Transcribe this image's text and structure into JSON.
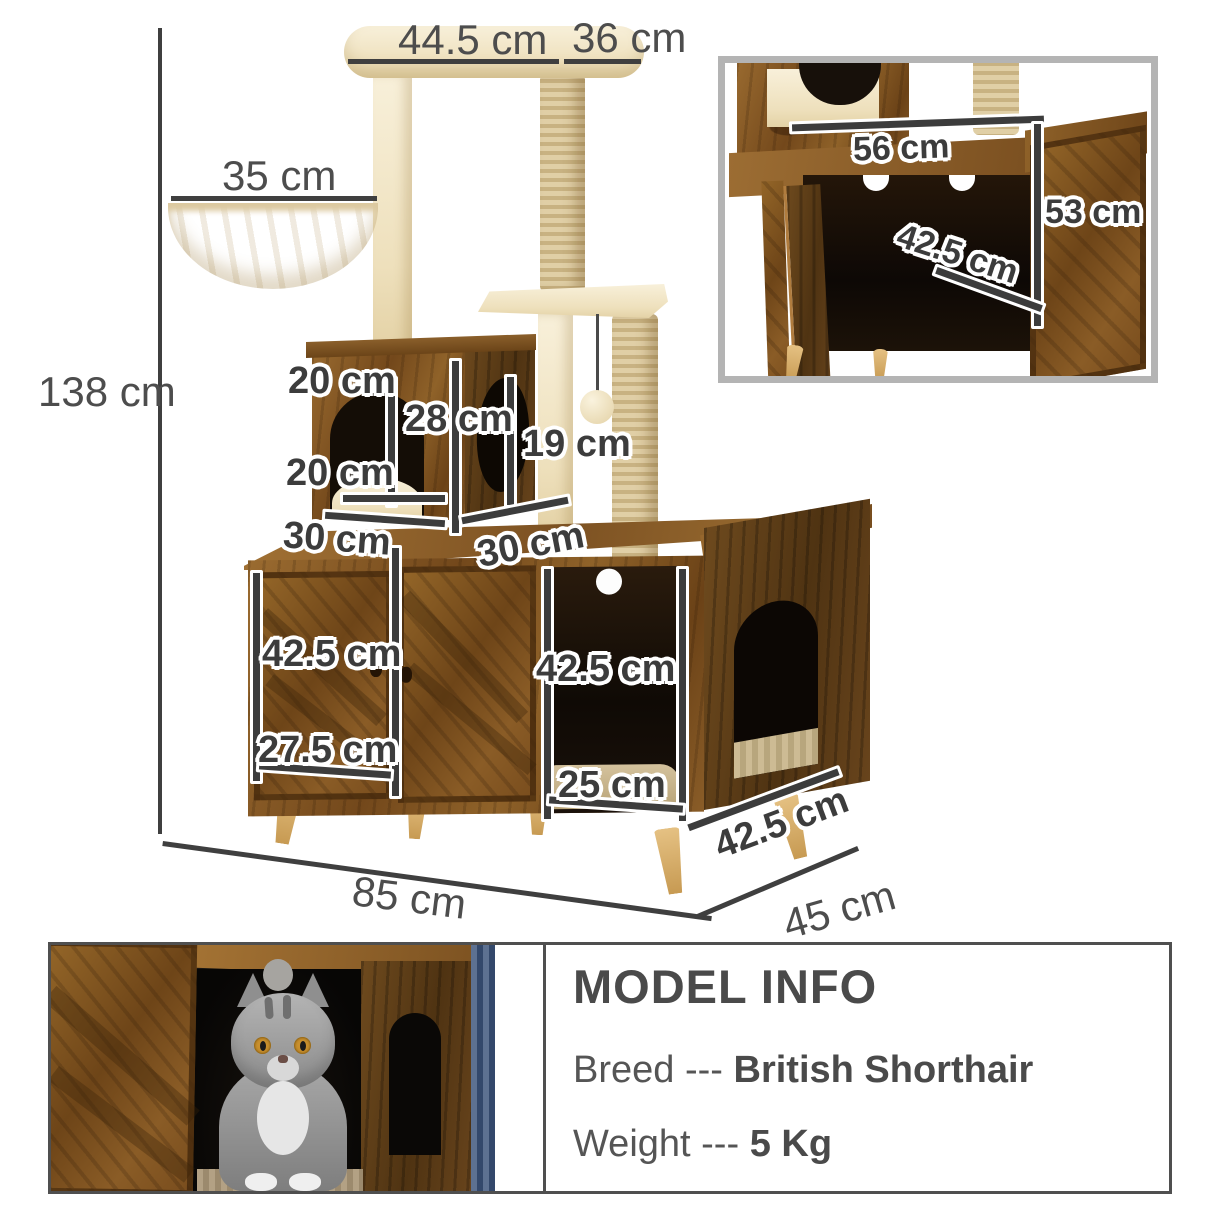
{
  "page_bg": "#ffffff",
  "colors": {
    "dim_line": "#3f3f3f",
    "label_text": "#4d4d4d",
    "wood": "#8a5d28",
    "wood_dark": "#5f3f1a",
    "plush": "#f5ecd3",
    "sisal": "#d8c69d",
    "leg_wood": "#d9b26d",
    "inset_border": "#b4b4b4",
    "panel_border": "#4f4f4f",
    "curtain_blue": "#49597b"
  },
  "diagram": {
    "height_total": "138 cm",
    "top_perch_length": "44.5 cm",
    "top_perch_depth": "36 cm",
    "hammock_width": "35 cm",
    "cube_opening_height": "20 cm",
    "cube_inner_height": "28 cm",
    "post_height": "19 cm",
    "cube_opening_width": "20 cm",
    "cube_width": "30 cm",
    "cube_depth": "30 cm",
    "door_height": "42.5 cm",
    "door_width": "27.5 cm",
    "opening_height": "42.5 cm",
    "opening_width": "25 cm",
    "unit_depth_side": "42.5 cm",
    "base_width": "85 cm",
    "base_depth": "45 cm"
  },
  "inset": {
    "interior_width": "56 cm",
    "interior_height": "53 cm",
    "interior_depth": "42.5 cm"
  },
  "model_info": {
    "title": "MODEL INFO",
    "breed_label": "Breed",
    "separator": "---",
    "breed_value": "British Shorthair",
    "weight_label": "Weight",
    "weight_value": "5 Kg"
  }
}
